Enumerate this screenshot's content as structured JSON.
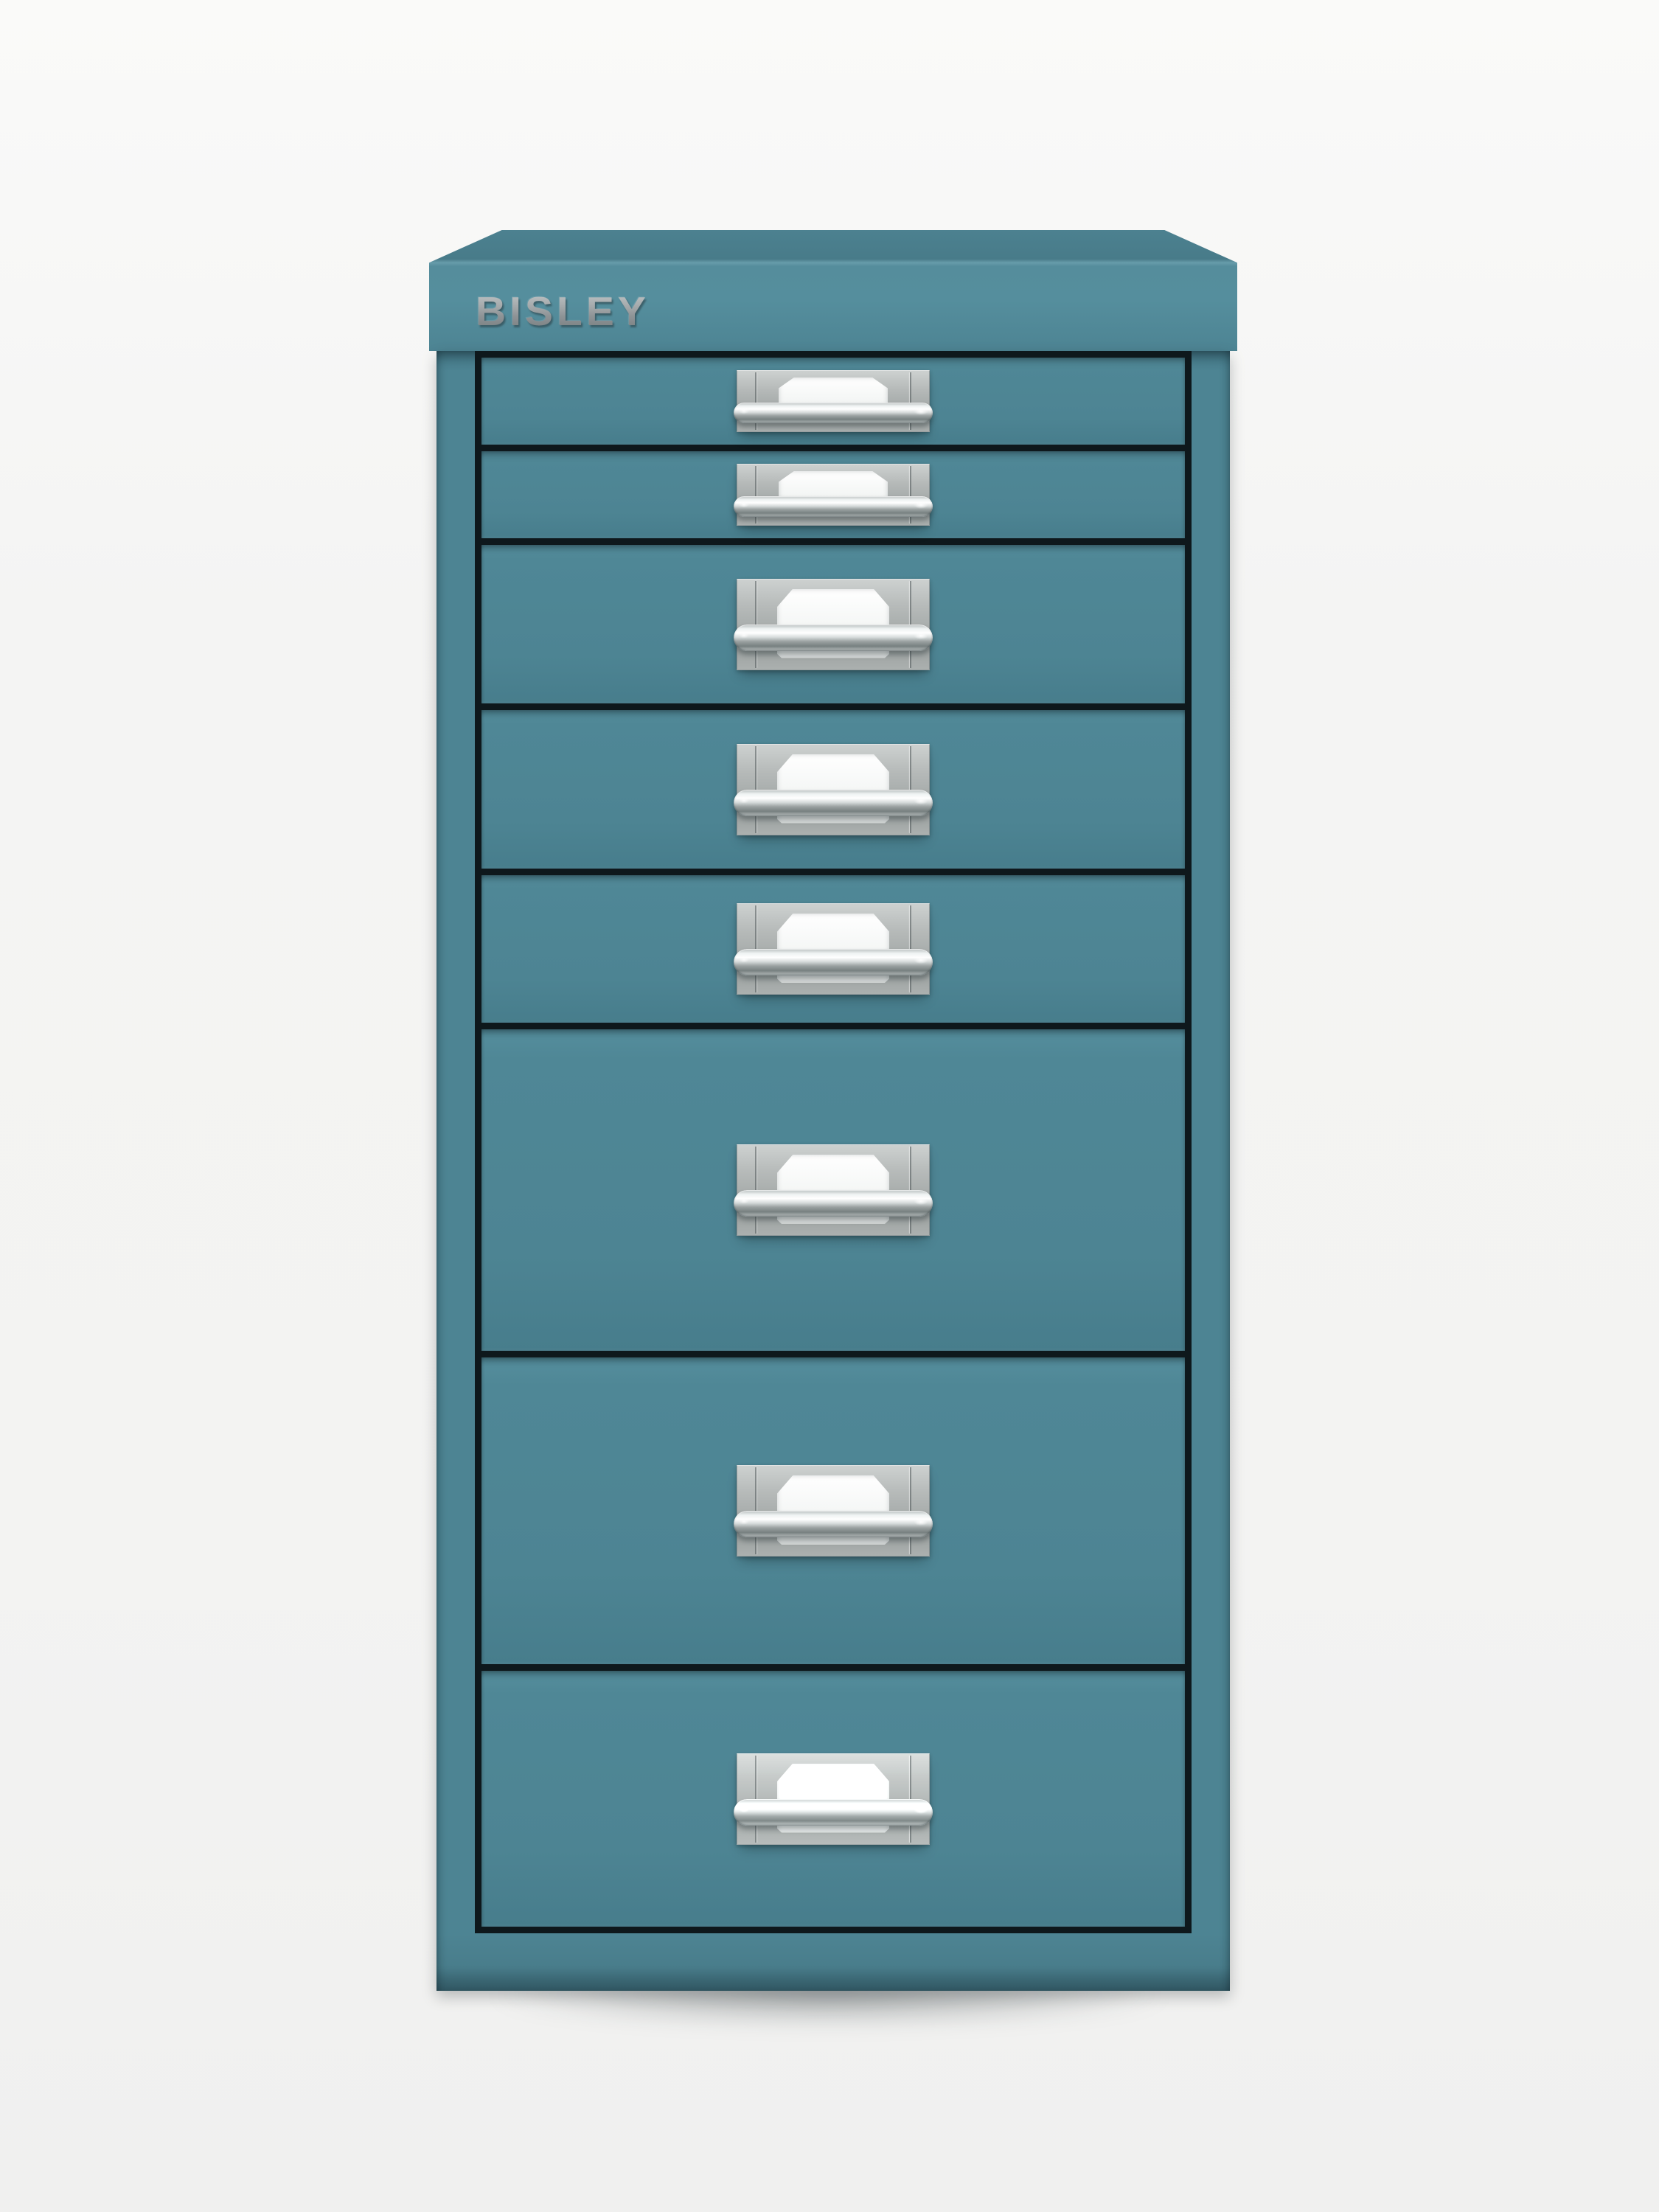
{
  "product": {
    "brand": "BISLEY",
    "type": "multidrawer-filing-cabinet",
    "drawer_count": 8,
    "drawers": [
      {
        "size": "small"
      },
      {
        "size": "small"
      },
      {
        "size": "medium"
      },
      {
        "size": "medium"
      },
      {
        "size": "medium"
      },
      {
        "size": "large"
      },
      {
        "size": "large"
      },
      {
        "size": "large"
      }
    ]
  },
  "colors": {
    "bg_top": "#fafaf9",
    "bg": "#f4f4f3",
    "teal": "#4d8493",
    "teal_light": "#558e9d",
    "teal_dark": "#3f6e7c",
    "cap_top": "#487b89",
    "cap_seam": "#679caa",
    "gap": "#0e181c",
    "plate_light": "#cdd1d0",
    "plate_dark": "#9da2a1",
    "chrome_white": "#ffffff",
    "chrome_dark": "#778080",
    "label": "#f4f6f5",
    "logo": "#8e9396",
    "shadow": "rgba(18,30,34,0.35)"
  }
}
